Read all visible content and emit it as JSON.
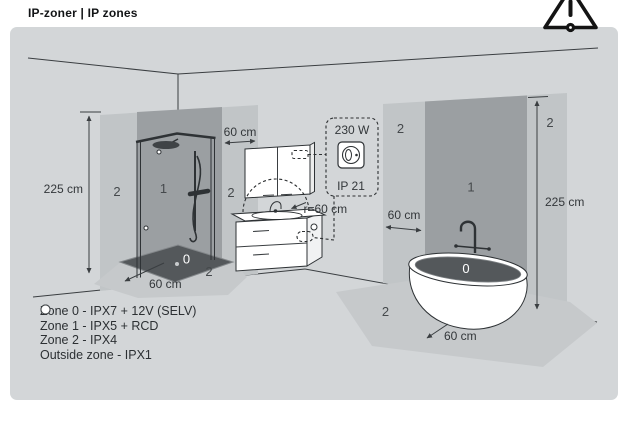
{
  "header": {
    "title": "IP-zoner | IP zones"
  },
  "icons": {
    "warning_icon": "warning-triangle-exclamation"
  },
  "colors": {
    "panel_bg": "#d3d6d8",
    "zone0": "#54585b",
    "zone1": "#9b9fa2",
    "zone2": "#c1c5c7",
    "floor_zone2": "#c6c9cb",
    "line": "#3a3e41",
    "white": "#ffffff"
  },
  "diagram": {
    "dimensions": {
      "left_wall_height": "225 cm",
      "right_wall_height": "225 cm",
      "shower_side_clearance": "60 cm",
      "socket_side_clearance": "60 cm",
      "shower_tray_depth": "60 cm",
      "bathtub_clearance": "60 cm",
      "splash_radius": "r=60 cm"
    },
    "socket": {
      "power": "230 W",
      "ip_rating": "IP 21"
    },
    "zones": {
      "left_wall": [
        "2",
        "1",
        "2"
      ],
      "shower_tray": "0",
      "shower_floor": "2",
      "right_wall": [
        "2",
        "1",
        "2"
      ],
      "bathtub": "0",
      "bathtub_floor": "2"
    }
  },
  "legend": {
    "items": [
      {
        "label": "Zone 0 - IPX7 + 12V (SELV)",
        "color": "#3f4346"
      },
      {
        "label": "Zone 1 - IPX5 + RCD",
        "color": "#7e8285"
      },
      {
        "label": "Zone 2 - IPX4",
        "color": "#c1c5c7"
      },
      {
        "label": "Outside zone - IPX1",
        "color": "#ffffff"
      }
    ]
  }
}
